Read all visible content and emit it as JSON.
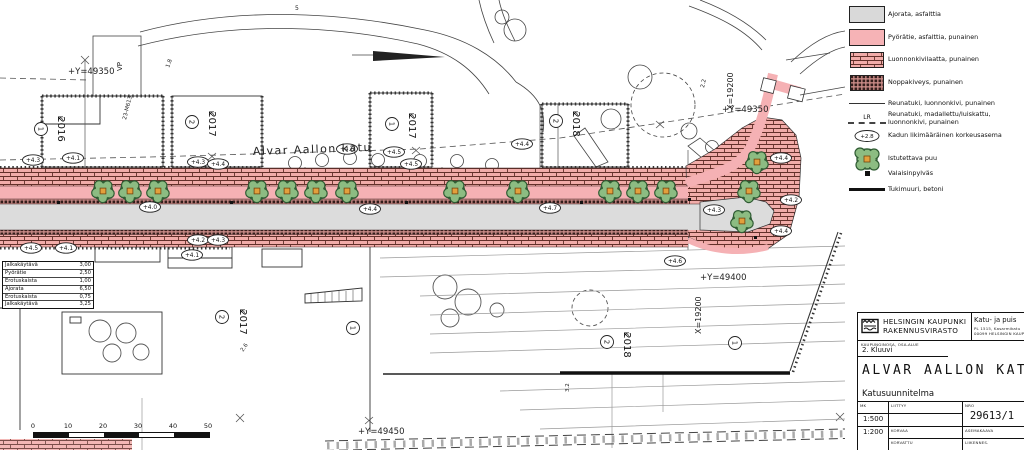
{
  "legend": {
    "items": [
      {
        "swatch": "asphalt",
        "label": "Ajorata, asfalttia"
      },
      {
        "swatch": "bike",
        "label": "Pyörätie, asfalttia, punainen"
      },
      {
        "swatch": "stone-slab",
        "label": "Luonnonkivilaatta, punainen"
      },
      {
        "swatch": "cobble",
        "label": "Noppakiveys, punainen"
      },
      {
        "swatch": "curb",
        "label": "Reunatuki, luonnonkivi, punainen"
      },
      {
        "swatch": "curb-lowered",
        "prefix": "LR",
        "label": "Reunatuki, madallettu/luiskattu, luonnonkivi, punainen"
      },
      {
        "swatch": "elevation",
        "symbol": "+2.8",
        "label": "Kadun likimääräinen korkeusasema"
      },
      {
        "swatch": "tree",
        "label": "Istutettava puu"
      },
      {
        "swatch": "lightpole",
        "label": "Valaisinpylväs"
      },
      {
        "swatch": "wall",
        "label": "Tukimuuri, betoni"
      }
    ]
  },
  "title_block": {
    "agency_line1": "HELSINGIN KAUPUNKI",
    "agency_line2": "RAKENNUSVIRASTO",
    "dept_line1": "Katu- ja puis",
    "dept_line2": "PL 1515, Kasarmikatu",
    "dept_line3": "00099 HELSINGIN KAUP",
    "district_label": "KAUPUNGINOSA, OSA-ALUE",
    "district_value": "2. Kluuvi",
    "title": "ALVAR AALLON KATU",
    "doc_type": "Katusuunnitelma",
    "scale_label": "MK",
    "scale1": "1:500",
    "scale2": "1:200",
    "liittyy_label": "LIITTYY",
    "korvaa_label": "KORVAA",
    "korvattu_label": "KORVATTU",
    "nro_label": "NRO",
    "drawing_number": "29613/1",
    "asemakaava_label": "ASEMAKAAVA",
    "liikenne_label": "LIIKENNES."
  },
  "plan": {
    "street_name": "Alvar Aallon katu",
    "colors": {
      "bike_pink": "#f5b1b4",
      "asphalt_gray": "#dcdcdc",
      "brick_pink": "#f1aca9",
      "brick_joint": "#63302a",
      "cobble_dark": "#321d1b",
      "tree_green": "#8cbc82",
      "tree_outline": "#2f5b33",
      "tree_square": "#e2a03c"
    },
    "labels": [
      {
        "t": "Alvar Aallon katu",
        "x": 253,
        "y": 155,
        "r": -2,
        "s": 11,
        "ls": 1.5
      },
      {
        "t": "+Y=49350",
        "x": 68,
        "y": 74,
        "s": 8.5,
        "m": 1
      },
      {
        "t": "+Y=49350",
        "x": 722,
        "y": 112,
        "s": 8.5,
        "m": 1
      },
      {
        "t": "X=19200",
        "x": 733,
        "y": 110,
        "r": -90,
        "s": 8,
        "m": 1
      },
      {
        "t": "+Y=49400",
        "x": 700,
        "y": 280,
        "s": 8.5,
        "m": 1
      },
      {
        "t": "X=19200",
        "x": 701,
        "y": 334,
        "r": -90,
        "s": 8,
        "m": 1
      },
      {
        "t": "+Y=49450",
        "x": 358,
        "y": 434,
        "s": 8.5,
        "m": 1
      },
      {
        "t": "VP",
        "x": 122,
        "y": 71,
        "r": -90,
        "s": 7
      },
      {
        "t": "23-M613",
        "x": 126,
        "y": 120,
        "r": -76,
        "s": 5.5
      },
      {
        "t": "1.8",
        "x": 169,
        "y": 68,
        "r": -70,
        "s": 5.5
      },
      {
        "t": "2.2",
        "x": 704,
        "y": 88,
        "r": -78,
        "s": 5.5
      },
      {
        "t": "2.6",
        "x": 243,
        "y": 352,
        "r": -55,
        "s": 5.5
      },
      {
        "t": "3.2",
        "x": 569,
        "y": 392,
        "r": -90,
        "s": 5.5
      },
      {
        "t": "5",
        "x": 295,
        "y": 10,
        "s": 6
      }
    ],
    "elevations": [
      {
        "v": "+4.3",
        "x": 33,
        "y": 160
      },
      {
        "v": "+4.1",
        "x": 73,
        "y": 158
      },
      {
        "v": "+4.3",
        "x": 198,
        "y": 162
      },
      {
        "v": "+4.4",
        "x": 218,
        "y": 164
      },
      {
        "v": "+4.6",
        "x": 347,
        "y": 149
      },
      {
        "v": "+4.5",
        "x": 394,
        "y": 152
      },
      {
        "v": "+4.5",
        "x": 411,
        "y": 164
      },
      {
        "v": "+4.4",
        "x": 522,
        "y": 144
      },
      {
        "v": "+4.4",
        "x": 781,
        "y": 158
      },
      {
        "v": "+4.2",
        "x": 791,
        "y": 200
      },
      {
        "v": "+4.4",
        "x": 781,
        "y": 231
      },
      {
        "v": "+4.6",
        "x": 675,
        "y": 261
      },
      {
        "v": "+4.0",
        "x": 150,
        "y": 207
      },
      {
        "v": "+4.4",
        "x": 370,
        "y": 209
      },
      {
        "v": "+4.7",
        "x": 550,
        "y": 208
      },
      {
        "v": "+4.3",
        "x": 714,
        "y": 210
      },
      {
        "v": "+4.5",
        "x": 31,
        "y": 248
      },
      {
        "v": "+4.1",
        "x": 66,
        "y": 248
      },
      {
        "v": "+4.2",
        "x": 198,
        "y": 240
      },
      {
        "v": "+4.3",
        "x": 218,
        "y": 240
      },
      {
        "v": "+4.1",
        "x": 192,
        "y": 255
      }
    ],
    "trees": [
      {
        "x": 103,
        "y": 191
      },
      {
        "x": 130,
        "y": 191
      },
      {
        "x": 158,
        "y": 191
      },
      {
        "x": 257,
        "y": 191
      },
      {
        "x": 287,
        "y": 191
      },
      {
        "x": 316,
        "y": 191
      },
      {
        "x": 347,
        "y": 191
      },
      {
        "x": 455,
        "y": 191
      },
      {
        "x": 518,
        "y": 191
      },
      {
        "x": 610,
        "y": 191
      },
      {
        "x": 638,
        "y": 191
      },
      {
        "x": 666,
        "y": 191
      },
      {
        "x": 757,
        "y": 162
      },
      {
        "x": 749,
        "y": 191
      },
      {
        "x": 742,
        "y": 221
      }
    ],
    "blocks": [
      {
        "n": "1",
        "y4": "2016",
        "cx": 41,
        "cy": 129,
        "tx": 58,
        "ty": 129
      },
      {
        "n": "2",
        "y4": "2017",
        "cx": 192,
        "cy": 122,
        "tx": 209,
        "ty": 124
      },
      {
        "n": "1",
        "y4": "2017",
        "cx": 392,
        "cy": 124,
        "tx": 409,
        "ty": 126
      },
      {
        "n": "2",
        "y4": "2018",
        "cx": 556,
        "cy": 121,
        "tx": 573,
        "ty": 124
      },
      {
        "n": "2",
        "y4": "2017",
        "cx": 222,
        "cy": 317,
        "tx": 240,
        "ty": 322
      },
      {
        "n": "2",
        "y4": "2018",
        "cx": 607,
        "cy": 342,
        "tx": 624,
        "ty": 345
      },
      {
        "n": "1",
        "y4": "",
        "cx": 735,
        "cy": 343,
        "tx": 0,
        "ty": 0
      },
      {
        "n": "1",
        "y4": "",
        "cx": 353,
        "cy": 328,
        "tx": 0,
        "ty": 0
      }
    ],
    "widths_table": [
      {
        "name": "Jalkakäytävä",
        "value": "3,00"
      },
      {
        "name": "Pyörätie",
        "value": "2,50"
      },
      {
        "name": "Erotuskaista",
        "value": "1,00"
      },
      {
        "name": "Ajorata",
        "value": "6,50"
      },
      {
        "name": "Erotuskaista",
        "value": "0,75"
      },
      {
        "name": "Jalkakäytävä",
        "value": "3,25"
      }
    ],
    "scale_bar": {
      "ticks": [
        "0",
        "10",
        "20",
        "30",
        "40",
        "50"
      ]
    }
  }
}
